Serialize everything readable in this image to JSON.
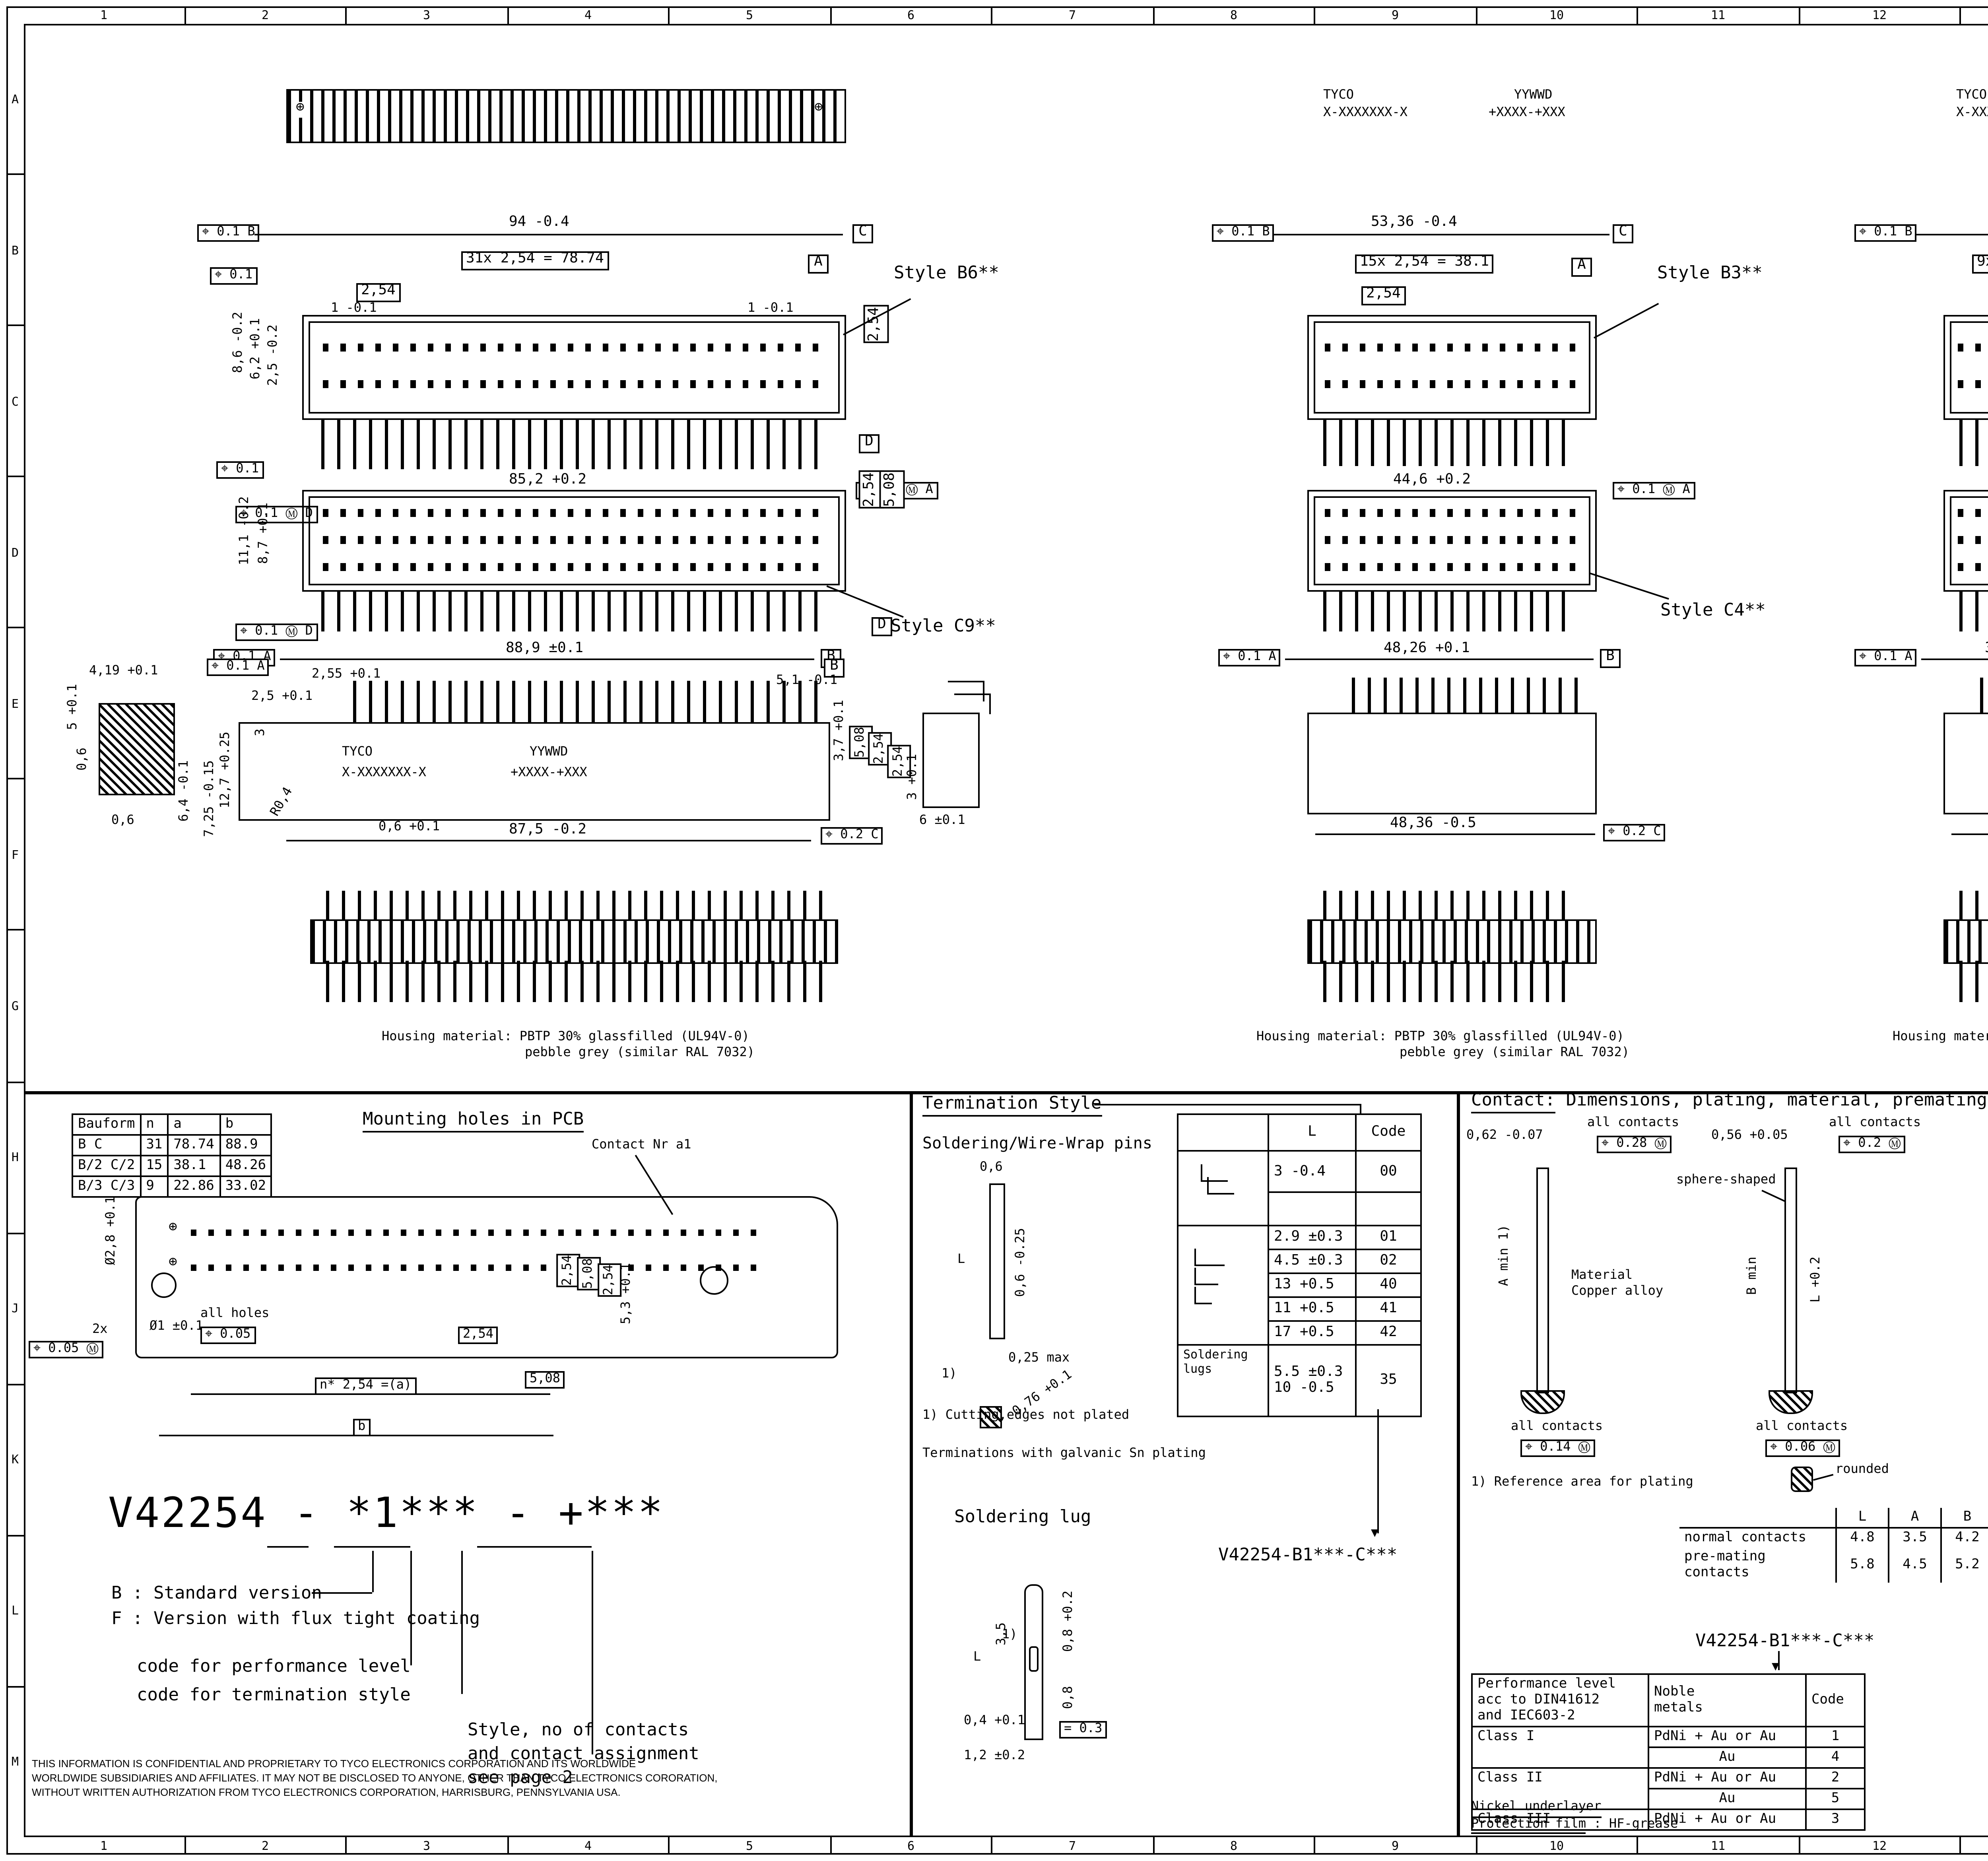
{
  "sheet": {
    "cols": [
      "1",
      "2",
      "3",
      "4",
      "5",
      "6",
      "7",
      "8",
      "9",
      "10",
      "11",
      "12",
      "13",
      "14",
      "15",
      "16"
    ],
    "rows": [
      "A",
      "B",
      "C",
      "D",
      "E",
      "F",
      "G",
      "H",
      "J",
      "K",
      "L",
      "M"
    ]
  },
  "icons": {
    "screw_hole": "⊕",
    "arrow_down": "▼"
  },
  "brand": {
    "tyco": "TYCO",
    "pn": "X-XXXXXXX-X",
    "date": "YYWWD",
    "lot": "+XXXX-+XXX"
  },
  "r1l": {
    "style": "Style B6**",
    "total": "94 -0.4",
    "pitch_eq": "31x 2,54 = 78.74",
    "pitch": "2,54",
    "end_l": "1 -0.1",
    "end_r": "1 -0.1",
    "h1": "8,6 -0.2",
    "h2": "6,2 +0.1",
    "h3": "2,5 -0.2",
    "vpitch": "2,54",
    "bottom": "85,2 +0.2",
    "fcf_top": "⌖ 0.1 B",
    "fcf_left": "⌖ 0.1",
    "fcf_bl": "⌖ 0.1 Ⓜ D",
    "fcf_br": "⌖ 0.1 Ⓜ A",
    "datum_c": "C",
    "datum_a": "A",
    "datum_d": "D"
  },
  "r1m": {
    "style": "Style B3**",
    "total": "53,36 -0.4",
    "pitch_eq": "15x 2,54 = 38.1",
    "pitch": "2,54",
    "bottom": "44,6 +0.2",
    "fcf_top": "⌖ 0.1 B",
    "fcf_br": "⌖ 0.1 Ⓜ A",
    "datum_c": "C",
    "datum_a": "A"
  },
  "r1r": {
    "style": "Style B2**",
    "total": "38,12 -0.4",
    "pitch_eq": "9x 2,54 = 22.86",
    "pitch": "2,54",
    "bottom": "29,42 +0.2",
    "fcf_top": "⌖ 0.1 B",
    "fcf_br": "⌖ 0.1 Ⓜ A",
    "datum_c": "C",
    "datum_a": "A"
  },
  "r2l": {
    "style": "Style C9**",
    "fcf_top": "⌖ 0.1",
    "h1": "11,1 -0.2",
    "h2": "8,7 +0.1",
    "vp1": "2,54",
    "vp2": "5,08",
    "fcf_bl": "⌖ 0.1 Ⓜ D",
    "datum_d": "D",
    "below": "88,9 ±0.1",
    "below_fcf": "⌖ 0.1 A",
    "datum_b": "B"
  },
  "r2m": {
    "style": "Style C4**",
    "below": "48,26 +0.1",
    "below_fcf": "⌖ 0.1 A",
    "datum_b": "B"
  },
  "r2r": {
    "style": "Style C3**",
    "below": "33,02 +0.1",
    "below_fcf": "⌖ 0.1 A",
    "datum_b": "B"
  },
  "r3l": {
    "d1": "4,19 +0.1",
    "d2": "5 +0.1",
    "d3": "0,6",
    "d4": "0,6",
    "d5": "6,4 -0.1",
    "fcf_a": "⌖ 0.1 A",
    "p1": "2,55 +0.1",
    "p2": "2,5 +0.1",
    "p3": "3",
    "p4": "12,7 +0.25",
    "p5": "7,25 -0.15",
    "p6": "R0,4",
    "p7": "87,5 -0.2",
    "p8": "0,6 +0.1",
    "r1": "5,1 -0.1",
    "r2": "3,7 +0.1",
    "r3": "5,08",
    "r4": "2,54",
    "r5": "2,54",
    "r6": "3 +0.1",
    "r7": "6 ±0.1",
    "fcf_c": "⌖ 0.2 C",
    "datum_b": "B"
  },
  "r3m": {
    "total": "48,36 -0.5",
    "fcf_c": "⌖ 0.2 C"
  },
  "r3r": {
    "total": "33,12 -0.5",
    "fcf_c": "⌖ 0.2 C"
  },
  "housing": {
    "l1": "Housing material: PBTP 30% glassfilled (UL94V-0)",
    "l2": "pebble grey (similar RAL 7032)"
  },
  "mount": {
    "title": "Mounting holes in PCB",
    "contact_label": "Contact Nr a1",
    "headers": [
      "Bauform",
      "n",
      "a",
      "b"
    ],
    "rows": [
      [
        "B  C",
        "31",
        "78.74",
        "88.9"
      ],
      [
        "B/2 C/2",
        "15",
        "38.1",
        "48.26"
      ],
      [
        "B/3 C/3",
        "9",
        "22.86",
        "33.02"
      ]
    ],
    "dia": "Ø2,8 +0.1",
    "two_x": "2x",
    "fcf1": "⌖ 0.05 Ⓜ",
    "hole": "Ø1 ±0.1",
    "all_holes": "all holes",
    "fcf2": "⌖ 0.05",
    "pitch": "2,54",
    "n_pitch": "n* 2,54 =(a)",
    "b": "b",
    "p508": "5,08",
    "rv1": "2,54",
    "rv2": "5,08",
    "rv3": "2,54",
    "rv4": "5,3 +0.1"
  },
  "pn": {
    "code": "V42254 - *1*** - +***",
    "b_line": "B : Standard version",
    "f_line": "F : Version with flux tight coating",
    "perf": "code for performance level",
    "term": "code for termination style",
    "s1": "Style, no of contacts",
    "s2": "and contact assignment",
    "s3": "see page 2"
  },
  "conf": {
    "l1": "THIS INFORMATION IS CONFIDENTIAL AND PROPRIETARY TO TYCO ELECTRONICS CORPORATION AND ITS WORLDWIDE",
    "l2": "WORLDWIDE SUBSIDIARIES AND AFFILIATES. IT MAY NOT BE DISCLOSED TO ANYONE, OTHER THAN TYCO ELECTRONICS CORORATION,",
    "l3": "WITHOUT WRITTEN AUTHORIZATION FROM TYCO ELECTRONICS CORPORATION, HARRISBURG, PENNSYLVANIA USA."
  },
  "term": {
    "title": "Termination Style",
    "sub": "Soldering/Wire-Wrap pins",
    "d1": "0,6",
    "d2": "L",
    "d3": "0,6 -0.25",
    "d4": "0,25 max",
    "ref": "1)",
    "sq": "0,76 +0.1",
    "col_l": "L",
    "col_code": "Code",
    "trows": [
      [
        "3  -0.4",
        "00"
      ],
      [
        "2.9 ±0.3",
        "01"
      ],
      [
        "4.5 ±0.3",
        "02"
      ],
      [
        "13  +0.5",
        "40"
      ],
      [
        "11  +0.5",
        "41"
      ],
      [
        "17  +0.5",
        "42"
      ]
    ],
    "lugs_label": "Soldering lugs",
    "lugs_l1": "5.5 ±0.3",
    "lugs_l2": "10  -0.5",
    "lugs_code": "35",
    "note1": "1) Cutting,edges not plated",
    "note2": "Terminations with galvanic Sn plating",
    "pn": "V42254-B1***-C***",
    "lug_title": "Soldering lug",
    "lg_l": "L",
    "lg_35": "3,5",
    "lg_ref": "1)",
    "lg_08a": "0,8 +0.2",
    "lg_08b": "0,8",
    "lg_04": "0,4 +0.1",
    "lg_fcf": "= 0.3",
    "lg_12": "1,2 ±0.2"
  },
  "contact": {
    "title_head": "Contact:",
    "title_rest": "Dimensions, plating, material, premating",
    "l_dia": "0,62 -0.07",
    "l_all1": "all contacts",
    "l_fcf1": "⌖ 0.28 Ⓜ",
    "l_amin": "A min 1)",
    "l_mat1": "Material",
    "l_mat2": "Copper alloy",
    "l_all2": "all contacts",
    "l_fcf2": "⌖ 0.14 Ⓜ",
    "r_dia": "0,56 +0.05",
    "r_all1": "all contacts",
    "r_fcf1": "⌖ 0.2 Ⓜ",
    "r_sphere": "sphere-shaped",
    "r_bmin": "B min",
    "r_l": "L +0.2",
    "r_all2": "all contacts",
    "r_fcf2": "⌖ 0.06 Ⓜ",
    "note": "1) Reference area for plating",
    "rounded": "rounded",
    "lab_h": [
      "L",
      "A",
      "B"
    ],
    "lab_r1": "normal  contacts",
    "lab_v1": [
      "4.8",
      "3.5",
      "4.2"
    ],
    "lab_r2": "pre-mating contacts",
    "lab_v2": [
      "5.8",
      "4.5",
      "5.2"
    ],
    "pn": "V42254-B1***-C***",
    "perf": {
      "h1a": "Performance level",
      "h1b": "acc to DIN41612",
      "h1c": "and IEC603-2",
      "h2a": "Noble",
      "h2b": "metals",
      "h3": "Code",
      "class1": "Class I",
      "m1": "PdNi + Au or Au",
      "c1": "1",
      "m2": "Au",
      "c2": "4",
      "class2": "Class II",
      "m3": "PdNi + Au or Au",
      "c3": "2",
      "m4": "Au",
      "c4": "5",
      "class3": "Class III",
      "m5": "PdNi + Au or Au",
      "c5": "3"
    },
    "nickel": "Nickel underlayer",
    "prot": "Protection film",
    "prot_v": ": HF-grease"
  },
  "male": {
    "title": "Male connecctor with board locks",
    "d1": "1.3 max",
    "d2": "1,85 +0.25",
    "d3": "3,35 +0.2",
    "d4": "3 max",
    "t1": [
      "Mounted in PC-boards",
      "of 1.5 to 1.8 mm",
      "Fm =< 60 N",
      "Fr >= 20 N",
      "Fr >= 200 N, wenn",
      "  soldered-in"
    ],
    "fm1": "Fm = Mounting force",
    "fm2": "(for 1 connector = 2 Clips)",
    "fr1": "Fr = Retention force",
    "fr2": "(for 1 connector = 2 Clips)",
    "t2": [
      "Mounted in PC-boards",
      "over 1.8 mm",
      "Fm =< 60 N",
      "Fr >= 16 N"
    ]
  },
  "tb": {
    "logo": "TE",
    "brand": "TE Connectivity",
    "loc": "Loc",
    "gw": "GW",
    "dims1": "DIMENSIONS",
    "dims2": "IN MM",
    "scale": "SCALE",
    "weight": "WEIGHT",
    "material": "MATERIAL",
    "date_l": "DATE",
    "date_v": "10.02.89",
    "name_l": "NAME",
    "name_v": "Cuvelier",
    "dep_l": "DEP.",
    "dep_v": "PD COM",
    "tol1": "TOLERANCE UNLESS",
    "tol2": "SPECIFIED OTHERWISE",
    "partname_l": "PART NAME",
    "partname1": "Pin Assembly Eurocard",
    "partname2": "Types B, C and short versions",
    "partno_l": "PART NO.",
    "partno": "V42254-B1***-C***-*-7626",
    "sht": "SHT.",
    "sht_v": "1+",
    "of": "OF",
    "of_v": "2",
    "rev": "REV.",
    "change": "CHANGE ORDER",
    "date2": "DATE",
    "app": "APP.",
    "customer": "Customer Drawing Nr.  C  1392009-8"
  }
}
